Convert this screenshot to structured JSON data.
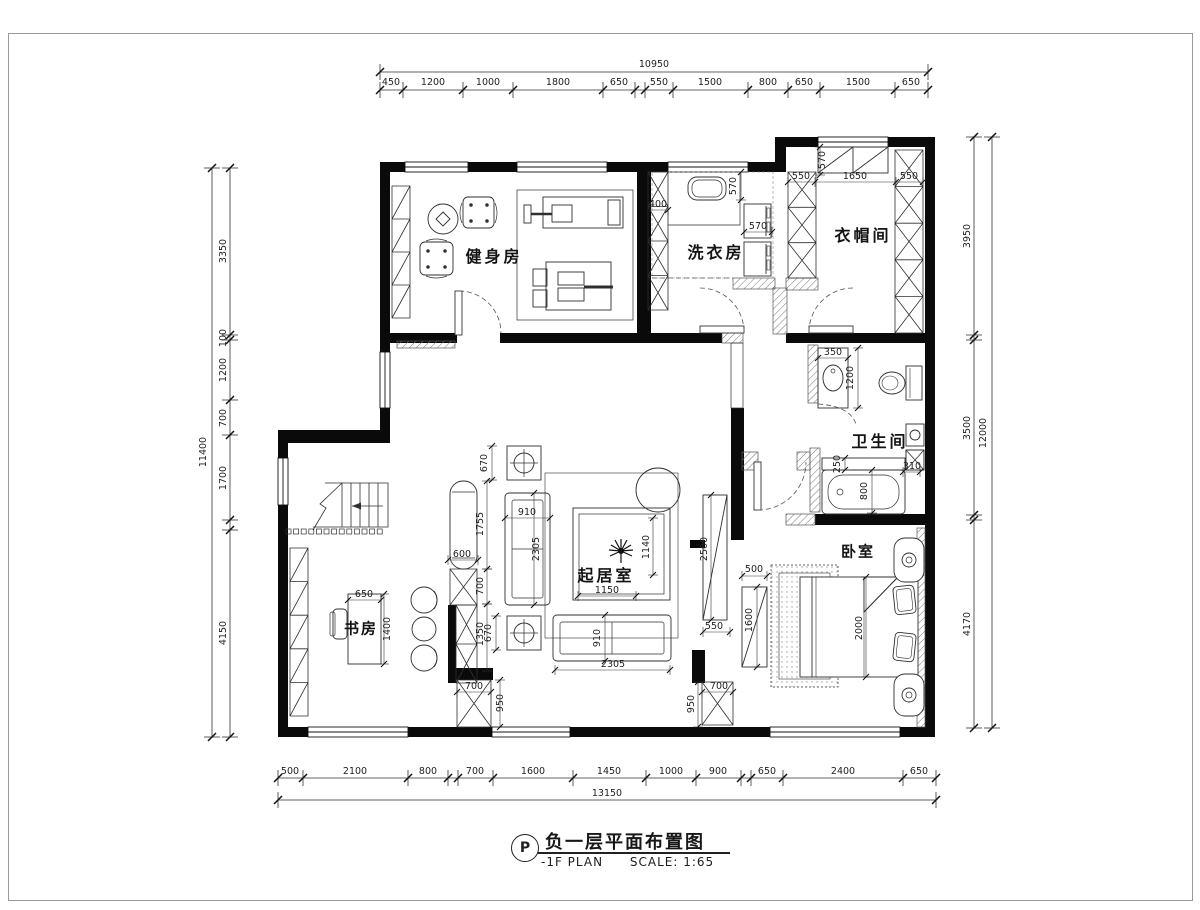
{
  "drawing": {
    "plan_symbol": "P",
    "title": "负一层平面布置图",
    "plan_name": "-1F PLAN",
    "scale": "SCALE: 1:65"
  },
  "rooms": {
    "gym": "健身房",
    "laundry": "洗衣房",
    "cloakroom": "衣帽间",
    "bathroom": "卫生间",
    "living_room": "起居室",
    "study": "书房",
    "bedroom": "卧室"
  },
  "dimension_chains": {
    "top": {
      "total": "10950",
      "segments": [
        "450",
        "1200",
        "1000",
        "1800",
        "650",
        "550",
        "1500",
        "800",
        "650",
        "1500",
        "650"
      ]
    },
    "bottom": {
      "total": "13150",
      "segments": [
        "500",
        "2100",
        "800",
        "700",
        "1600",
        "1450",
        "1000",
        "900",
        "650",
        "2400",
        "650"
      ]
    },
    "left": {
      "total": "11400",
      "segments": [
        "3350",
        "100",
        "1200",
        "700",
        "1700",
        "4150"
      ]
    },
    "right": {
      "total": "12000",
      "segments": [
        "3950",
        "3500",
        "4170"
      ]
    }
  },
  "dimension_labels": [
    {
      "t": "10950",
      "x": 654,
      "y": 67
    },
    {
      "t": "450",
      "x": 391,
      "y": 85
    },
    {
      "t": "1200",
      "x": 433,
      "y": 85
    },
    {
      "t": "1000",
      "x": 488,
      "y": 85
    },
    {
      "t": "1800",
      "x": 558,
      "y": 85
    },
    {
      "t": "650",
      "x": 619,
      "y": 85
    },
    {
      "t": "550",
      "x": 659,
      "y": 85
    },
    {
      "t": "1500",
      "x": 710,
      "y": 85
    },
    {
      "t": "800",
      "x": 768,
      "y": 85
    },
    {
      "t": "650",
      "x": 804,
      "y": 85
    },
    {
      "t": "1500",
      "x": 858,
      "y": 85
    },
    {
      "t": "650",
      "x": 911,
      "y": 85
    },
    {
      "t": "13150",
      "x": 607,
      "y": 796
    },
    {
      "t": "500",
      "x": 290,
      "y": 774
    },
    {
      "t": "2100",
      "x": 355,
      "y": 774
    },
    {
      "t": "800",
      "x": 428,
      "y": 774
    },
    {
      "t": "700",
      "x": 475,
      "y": 774
    },
    {
      "t": "1600",
      "x": 533,
      "y": 774
    },
    {
      "t": "1450",
      "x": 609,
      "y": 774
    },
    {
      "t": "1000",
      "x": 671,
      "y": 774
    },
    {
      "t": "900",
      "x": 718,
      "y": 774
    },
    {
      "t": "650",
      "x": 767,
      "y": 774
    },
    {
      "t": "2400",
      "x": 843,
      "y": 774
    },
    {
      "t": "650",
      "x": 919,
      "y": 774
    },
    {
      "t": "11400",
      "x": 206,
      "y": 452,
      "r": -90
    },
    {
      "t": "3350",
      "x": 226,
      "y": 251,
      "r": -90
    },
    {
      "t": "100",
      "x": 226,
      "y": 338,
      "r": -90
    },
    {
      "t": "1200",
      "x": 226,
      "y": 370,
      "r": -90
    },
    {
      "t": "700",
      "x": 226,
      "y": 418,
      "r": -90
    },
    {
      "t": "1700",
      "x": 226,
      "y": 478,
      "r": -90
    },
    {
      "t": "4150",
      "x": 226,
      "y": 633,
      "r": -90
    },
    {
      "t": "12000",
      "x": 986,
      "y": 433,
      "r": -90
    },
    {
      "t": "3950",
      "x": 970,
      "y": 236,
      "r": -90
    },
    {
      "t": "3500",
      "x": 970,
      "y": 428,
      "r": -90
    },
    {
      "t": "4170",
      "x": 970,
      "y": 624,
      "r": -90
    },
    {
      "t": "400",
      "x": 658,
      "y": 207
    },
    {
      "t": "570",
      "x": 736,
      "y": 186,
      "r": -90
    },
    {
      "t": "570",
      "x": 758,
      "y": 229
    },
    {
      "t": "570",
      "x": 825,
      "y": 160,
      "r": -90
    },
    {
      "t": "550",
      "x": 801,
      "y": 179
    },
    {
      "t": "1650",
      "x": 855,
      "y": 179
    },
    {
      "t": "550",
      "x": 909,
      "y": 179
    },
    {
      "t": "350",
      "x": 833,
      "y": 355
    },
    {
      "t": "1200",
      "x": 853,
      "y": 378,
      "r": -90
    },
    {
      "t": "250",
      "x": 840,
      "y": 464,
      "r": -90
    },
    {
      "t": "800",
      "x": 867,
      "y": 491,
      "r": -90
    },
    {
      "t": "310",
      "x": 912,
      "y": 469
    },
    {
      "t": "670",
      "x": 487,
      "y": 463,
      "r": -90
    },
    {
      "t": "910",
      "x": 527,
      "y": 515
    },
    {
      "t": "2305",
      "x": 539,
      "y": 549,
      "r": -90
    },
    {
      "t": "1150",
      "x": 607,
      "y": 593
    },
    {
      "t": "1140",
      "x": 649,
      "y": 547,
      "r": -90
    },
    {
      "t": "670",
      "x": 491,
      "y": 633,
      "r": -90
    },
    {
      "t": "910",
      "x": 600,
      "y": 638,
      "r": -90
    },
    {
      "t": "2305",
      "x": 613,
      "y": 667
    },
    {
      "t": "600",
      "x": 462,
      "y": 557
    },
    {
      "t": "1755",
      "x": 483,
      "y": 524,
      "r": -90
    },
    {
      "t": "700",
      "x": 483,
      "y": 586,
      "r": -90
    },
    {
      "t": "1350",
      "x": 483,
      "y": 634,
      "r": -90
    },
    {
      "t": "650",
      "x": 364,
      "y": 597
    },
    {
      "t": "1400",
      "x": 390,
      "y": 629,
      "r": -90
    },
    {
      "t": "2500",
      "x": 707,
      "y": 549,
      "r": -90
    },
    {
      "t": "550",
      "x": 714,
      "y": 629
    },
    {
      "t": "500",
      "x": 754,
      "y": 572
    },
    {
      "t": "1600",
      "x": 752,
      "y": 620,
      "r": -90
    },
    {
      "t": "700",
      "x": 474,
      "y": 689
    },
    {
      "t": "950",
      "x": 503,
      "y": 703,
      "r": -90
    },
    {
      "t": "700",
      "x": 719,
      "y": 689
    },
    {
      "t": "950",
      "x": 694,
      "y": 704,
      "r": -90
    },
    {
      "t": "2000",
      "x": 862,
      "y": 628,
      "r": -90
    }
  ]
}
